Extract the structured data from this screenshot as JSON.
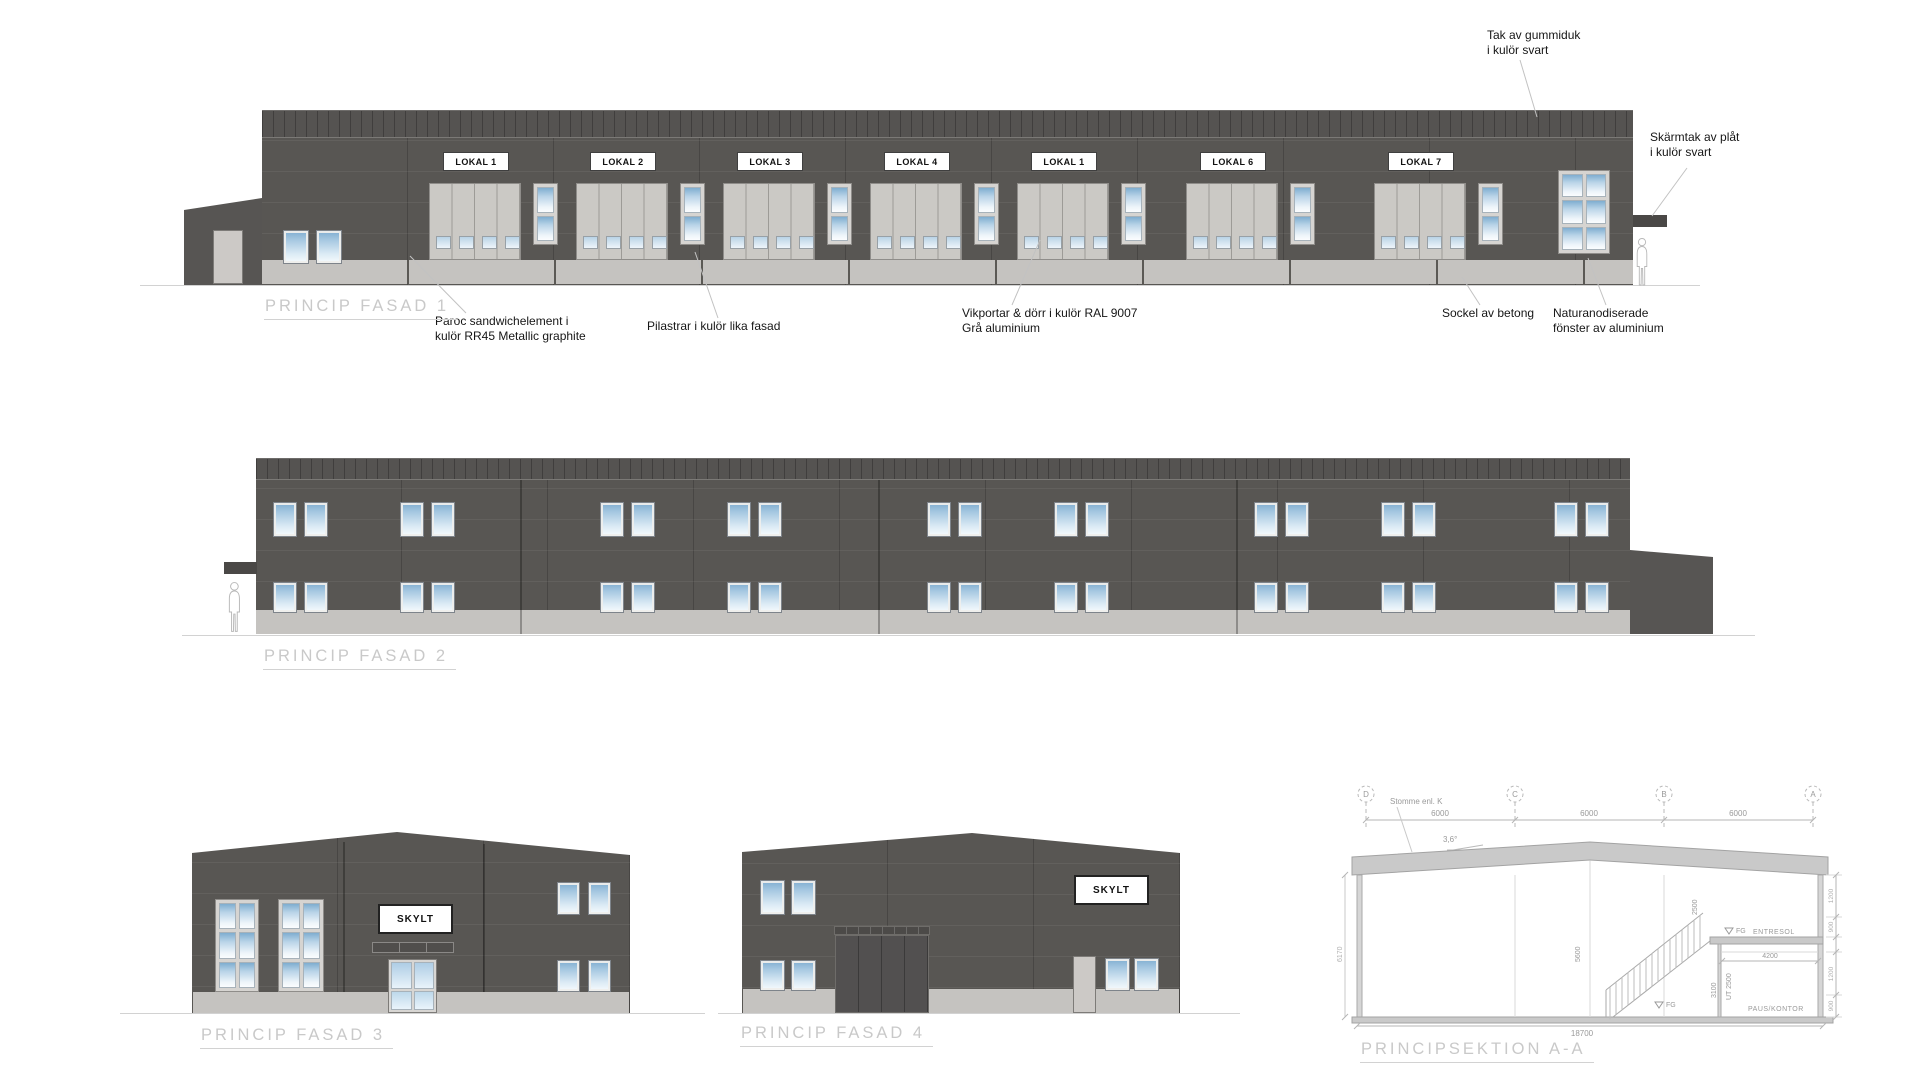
{
  "colors": {
    "facade_dark": "#585653",
    "panel_light": "#cbc9c5",
    "sockel_concrete": "#c5c3c0",
    "window_blue": "#7fadd0",
    "door_dark": "#525050",
    "title_gray": "#c9c9c9",
    "drawing_line_gray": "#a9a9a9"
  },
  "fasad1": {
    "title": "PRINCIP FASAD 1",
    "bay_labels": [
      "LOKAL 1",
      "LOKAL 2",
      "LOKAL 3",
      "LOKAL 4",
      "LOKAL 1",
      "LOKAL 6",
      "LOKAL 7"
    ],
    "annotations": {
      "roof": "Tak av gummiduk\ni kulör svart",
      "canopy": "Skärmtak av plåt\ni kulör svart",
      "walls": "Paroc sandwichelement i\nkulör RR45 Metallic graphite",
      "pilasters": "Pilastrar i kulör lika fasad",
      "doors": "Vikportar & dörr i kulör RAL 9007\nGrå aluminium",
      "base": "Sockel av betong",
      "windows": "Naturanodiserade\nfönster av aluminium"
    }
  },
  "fasad2": {
    "title": "PRINCIP FASAD 2"
  },
  "fasad3": {
    "title": "PRINCIP FASAD 3",
    "sign": "SKYLT"
  },
  "fasad4": {
    "title": "PRINCIP FASAD 4",
    "sign": "SKYLT"
  },
  "sektion": {
    "title": "PRINCIPSEKTION A-A",
    "grid_bubbles": [
      "D",
      "C",
      "B",
      "A"
    ],
    "span_dims": [
      "6000",
      "6000",
      "6000"
    ],
    "frame_note": "Stomme enl. K",
    "roof_slope": "3,6°",
    "total_width_dim": "18700",
    "left_height_dim": "6170",
    "interior_height_dim": "5600",
    "stair_height_dim": "2500",
    "mezzanine_label": "ENTRESOL",
    "room_label": "PAUS/KONTOR",
    "room_width_dim": "4200",
    "room_height_dim": "3100",
    "clear_height_dim": "UT 2500",
    "level_marker_upper": "FG",
    "level_marker_lower": "FG",
    "right_dims": [
      "1200",
      "900",
      "1200",
      "900"
    ]
  }
}
